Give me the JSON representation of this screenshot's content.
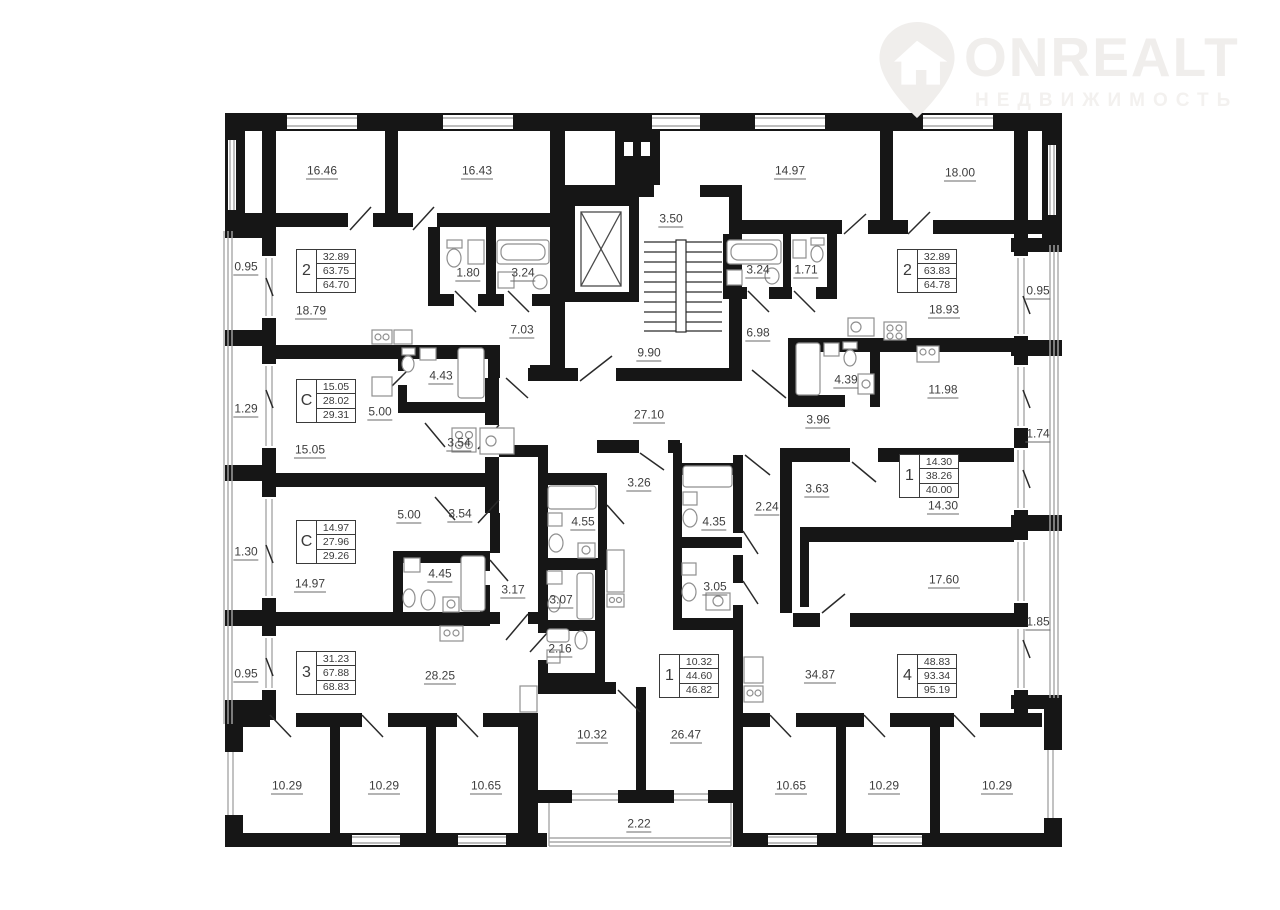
{
  "logo": {
    "brand": "ONREALT",
    "subtitle": "НЕДВИЖИМОСТЬ"
  },
  "colors": {
    "wall": "#161616",
    "label_text": "#3e3e3e",
    "window": "#a8a8a8",
    "fixture": "#8f8f8f",
    "logo": "#f0eeec"
  },
  "icons": [
    "logo-pin-icon",
    "elevator-icon",
    "stairs-icon",
    "bathtub-icon",
    "toilet-icon",
    "sink-icon",
    "stove-icon",
    "washer-icon",
    "fridge-icon",
    "door-swing-icon",
    "window-icon"
  ],
  "apartments": [
    {
      "type": "2",
      "living": "32.89",
      "area": "63.75",
      "total": "64.70"
    },
    {
      "type": "2",
      "living": "32.89",
      "area": "63.83",
      "total": "64.78"
    },
    {
      "type": "С",
      "living": "15.05",
      "area": "28.02",
      "total": "29.31"
    },
    {
      "type": "1",
      "living": "14.30",
      "area": "38.26",
      "total": "40.00"
    },
    {
      "type": "С",
      "living": "14.97",
      "area": "27.96",
      "total": "29.26"
    },
    {
      "type": "3",
      "living": "31.23",
      "area": "67.88",
      "total": "68.83"
    },
    {
      "type": "1",
      "living": "10.32",
      "area": "44.60",
      "total": "46.82"
    },
    {
      "type": "4",
      "living": "48.83",
      "area": "93.34",
      "total": "95.19"
    }
  ],
  "rooms": [
    {
      "label": "16.46"
    },
    {
      "label": "16.43"
    },
    {
      "label": "0.95"
    },
    {
      "label": "18.79"
    },
    {
      "label": "1.80"
    },
    {
      "label": "3.24"
    },
    {
      "label": "7.03"
    },
    {
      "label": "3.50"
    },
    {
      "label": "9.90"
    },
    {
      "label": "14.97"
    },
    {
      "label": "18.00"
    },
    {
      "label": "3.24"
    },
    {
      "label": "1.71"
    },
    {
      "label": "6.98"
    },
    {
      "label": "18.93"
    },
    {
      "label": "0.95"
    },
    {
      "label": "1.29"
    },
    {
      "label": "5.00"
    },
    {
      "label": "4.43"
    },
    {
      "label": "15.05"
    },
    {
      "label": "3.54"
    },
    {
      "label": "27.10"
    },
    {
      "label": "4.39"
    },
    {
      "label": "3.96"
    },
    {
      "label": "11.98"
    },
    {
      "label": "1.74"
    },
    {
      "label": "3.63"
    },
    {
      "label": "14.30"
    },
    {
      "label": "1.30"
    },
    {
      "label": "5.00"
    },
    {
      "label": "3.54"
    },
    {
      "label": "14.97"
    },
    {
      "label": "4.45"
    },
    {
      "label": "3.17"
    },
    {
      "label": "3.26"
    },
    {
      "label": "4.55"
    },
    {
      "label": "4.35"
    },
    {
      "label": "2.24"
    },
    {
      "label": "3.07"
    },
    {
      "label": "3.05"
    },
    {
      "label": "2.16"
    },
    {
      "label": "0.95"
    },
    {
      "label": "28.25"
    },
    {
      "label": "10.29"
    },
    {
      "label": "10.29"
    },
    {
      "label": "10.65"
    },
    {
      "label": "10.32"
    },
    {
      "label": "26.47"
    },
    {
      "label": "2.22"
    },
    {
      "label": "34.87"
    },
    {
      "label": "17.60"
    },
    {
      "label": "1.85"
    },
    {
      "label": "10.65"
    },
    {
      "label": "10.29"
    },
    {
      "label": "10.29"
    }
  ]
}
